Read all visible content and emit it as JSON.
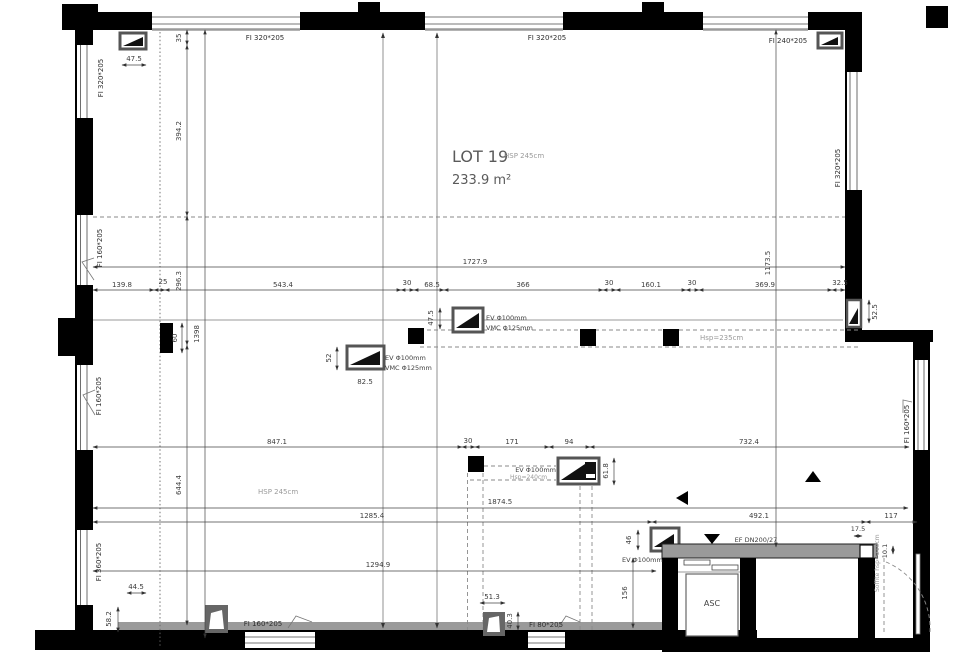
{
  "lot": {
    "name": "LOT 19",
    "area": "233.9 m²",
    "hsp": "HSP 245cm"
  },
  "labels": {
    "hsp235": "Hsp=235cm",
    "hsp240": "Hsp=240cm",
    "hsp245": "HSP 245cm",
    "soffite": "Soffite hsp=210cm",
    "asc": "ASC",
    "ef": "EF DN200/27",
    "ev": "EV Φ100mm",
    "vmc": "VMC Φ125mm"
  },
  "windows": {
    "left_top": "FI 320*205",
    "top_left": "FI 320*205",
    "top_mid": "FI 320*205",
    "top_right": "FI 240*205",
    "right_top": "FI 320*205",
    "left_mid1": "FI 160*205",
    "left_mid2": "FI 160*205",
    "left_bottom": "FI 360*205",
    "bottom_left": "FI 160*205",
    "bottom_mid": "FI 80*205",
    "right_mid": "FI 160*205"
  },
  "dims": {
    "d1727_9": "1727.9",
    "d1173_5": "1173.5",
    "d139_8": "139.8",
    "d25": "25",
    "d543_4": "543.4",
    "d30": "30",
    "d68_5": "68.5",
    "d366": "366",
    "d160_1": "160.1",
    "d369_9": "369.9",
    "d32_5": "32.5",
    "d394_2": "394.2",
    "d35": "35",
    "d296_3": "296.3",
    "d644_4": "644.4",
    "d1398": "1398",
    "d60": "60",
    "d47_5": "47.5",
    "d52": "52",
    "d82_5": "82.5",
    "d52_5": "52.5",
    "d847_1": "847.1",
    "d171": "171",
    "d94": "94",
    "d732_4": "732.4",
    "d61_8": "61.8",
    "d1874_5": "1874.5",
    "d1285_4": "1285.4",
    "d492_1": "492.1",
    "d117": "117",
    "d1294_9": "1294.9",
    "d46": "46",
    "d156": "156",
    "d17_5": "17.5",
    "d10_1": "10.1",
    "d44_5": "44.5",
    "d58_2": "58.2",
    "d51_3": "51.3",
    "d40_3": "40.3"
  },
  "colors": {
    "wall": "#000000",
    "sill": "#9a9a9a",
    "dim_line": "#444444",
    "muted_text": "#9a9a9a"
  }
}
